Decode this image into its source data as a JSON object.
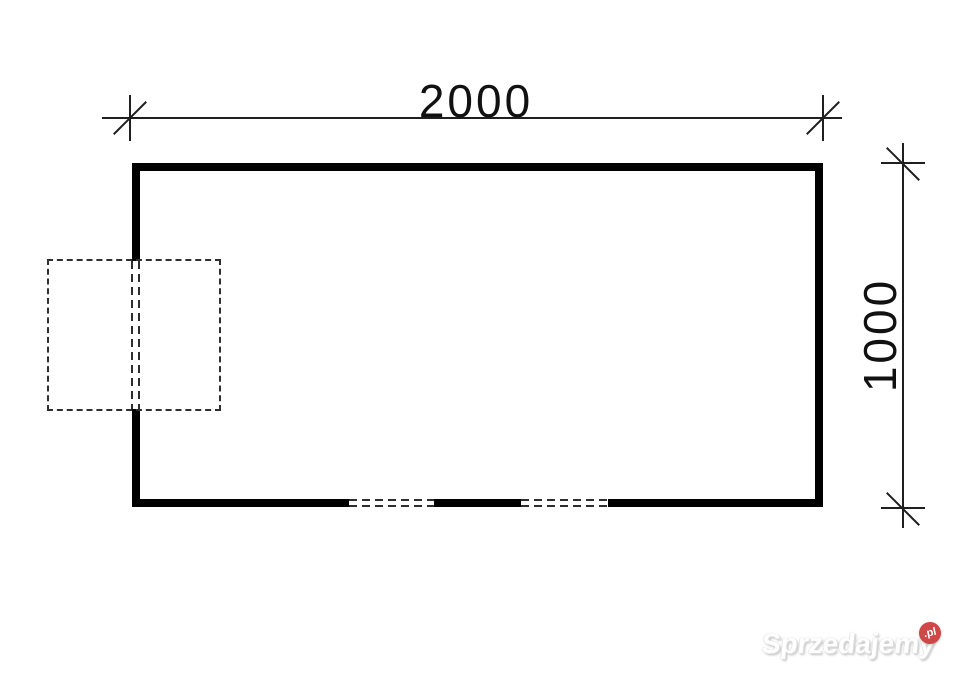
{
  "plan": {
    "width_label": "2000",
    "height_label": "1000"
  },
  "watermark": {
    "brand": "Sprzedajemy",
    "tld": ".pl",
    "badge_color": "#cf4747",
    "text_color": "#ffffff"
  },
  "colors": {
    "background": "#ffffff",
    "wall": "#000000",
    "dashed_line": "#2f2f2f",
    "dimension_line": "#1f1f1f",
    "label_text": "#111111"
  }
}
